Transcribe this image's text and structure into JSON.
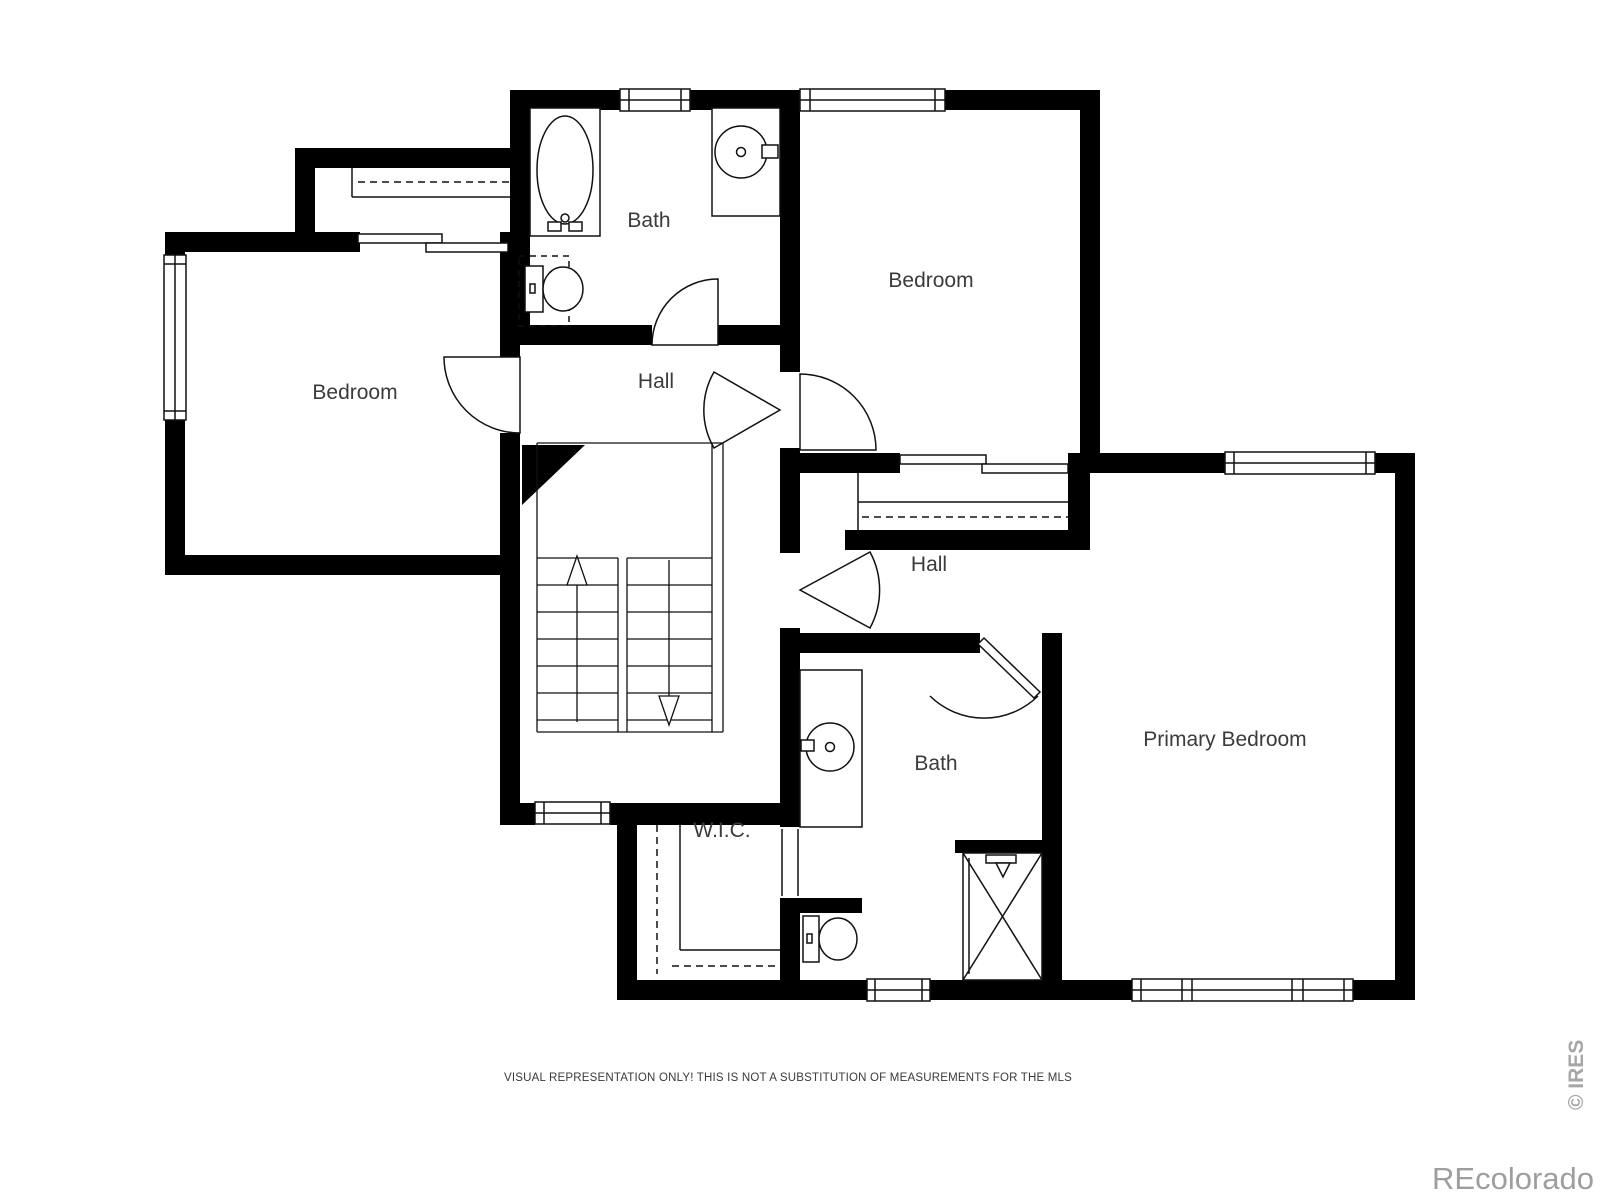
{
  "floorplan": {
    "rooms": [
      {
        "id": "bath-upper",
        "label": "Bath"
      },
      {
        "id": "bedroom-top",
        "label": "Bedroom"
      },
      {
        "id": "bedroom-left",
        "label": "Bedroom"
      },
      {
        "id": "hall-upper",
        "label": "Hall"
      },
      {
        "id": "hall-right",
        "label": "Hall"
      },
      {
        "id": "primary-bedroom",
        "label": "Primary Bedroom"
      },
      {
        "id": "bath-lower",
        "label": "Bath"
      },
      {
        "id": "wic",
        "label": "W.I.C."
      }
    ],
    "colors": {
      "wall": "#000000",
      "line": "#111111",
      "label": "#3b3b3b",
      "background": "#ffffff"
    }
  },
  "footer": {
    "disclaimer": "VISUAL REPRESENTATION ONLY! THIS IS NOT A SUBSTITUTION OF MEASUREMENTS FOR THE MLS"
  },
  "watermarks": {
    "brand": "REcolorado",
    "source": "© IRES",
    "color": "#9e9e9e"
  }
}
